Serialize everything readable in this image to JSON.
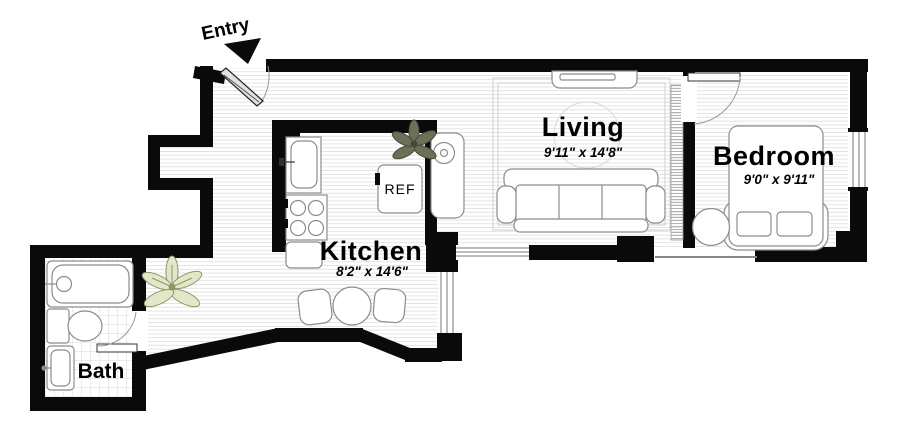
{
  "entry": {
    "label": "Entry"
  },
  "rooms": [
    {
      "name": "Living",
      "dimensions": "9'11\" x 14'8\""
    },
    {
      "name": "Bedroom",
      "dimensions": "9'0\" x 9'11\""
    },
    {
      "name": "Kitchen",
      "dimensions": "8'2\" x 14'6\""
    },
    {
      "name": "Bath",
      "dimensions": ""
    }
  ],
  "labels": {
    "refrigerator": "REF"
  },
  "fixtures": [
    "entry-door",
    "bedroom-door",
    "bath-door",
    "bathtub",
    "toilet",
    "bathroom-sink",
    "kitchen-sink",
    "stove",
    "refrigerator",
    "island-counter",
    "lower-counter",
    "dining-table",
    "dining-chair-left",
    "dining-chair-right",
    "sofa",
    "tv-console",
    "area-rug",
    "rug-circle",
    "bed",
    "pillows",
    "bedside-chair",
    "plant-kitchen",
    "plant-hall",
    "window-living-south",
    "window-dining-east",
    "window-bedroom-east"
  ],
  "colors": {
    "wall": "#0a0a0a",
    "floor_line": "#e3e3e3",
    "tile_line": "#d9d9d9",
    "fixture_stroke": "#8c8c8c",
    "plant_dark_fill": "#6b7157",
    "plant_dark_stroke": "#454a36",
    "plant_light_fill": "#e2e7c9",
    "plant_light_stroke": "#8e9665"
  }
}
